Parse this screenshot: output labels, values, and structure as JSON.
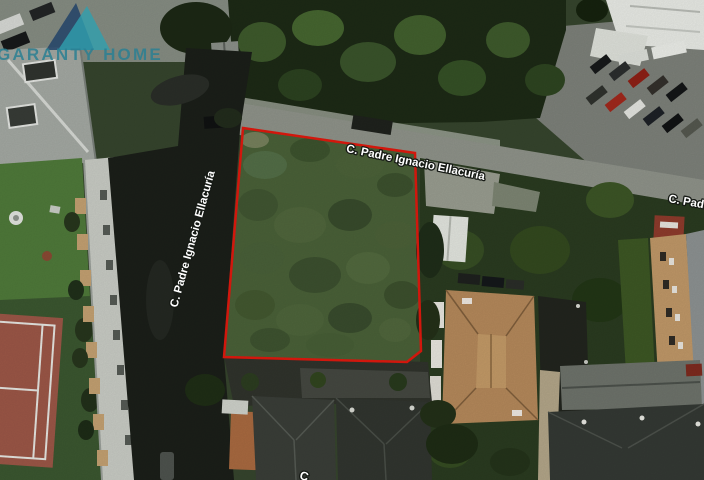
{
  "brand": {
    "name": "GARANTY HOME",
    "icon": "twin-triangle-house",
    "navy": "#1e4066",
    "teal": "#2fa0af",
    "text_color": "#2b8093"
  },
  "map": {
    "type": "aerial-satellite-photo",
    "street_labels": {
      "top_road": "C. Padre Ignacio Ellacuría",
      "left_road": "C. Padre Ignacio Ellacuría",
      "right_edge": "C. Padre Ignacio Ellacuría",
      "bottom_edge": "C"
    },
    "plot_outline_color": "#e0190e"
  }
}
